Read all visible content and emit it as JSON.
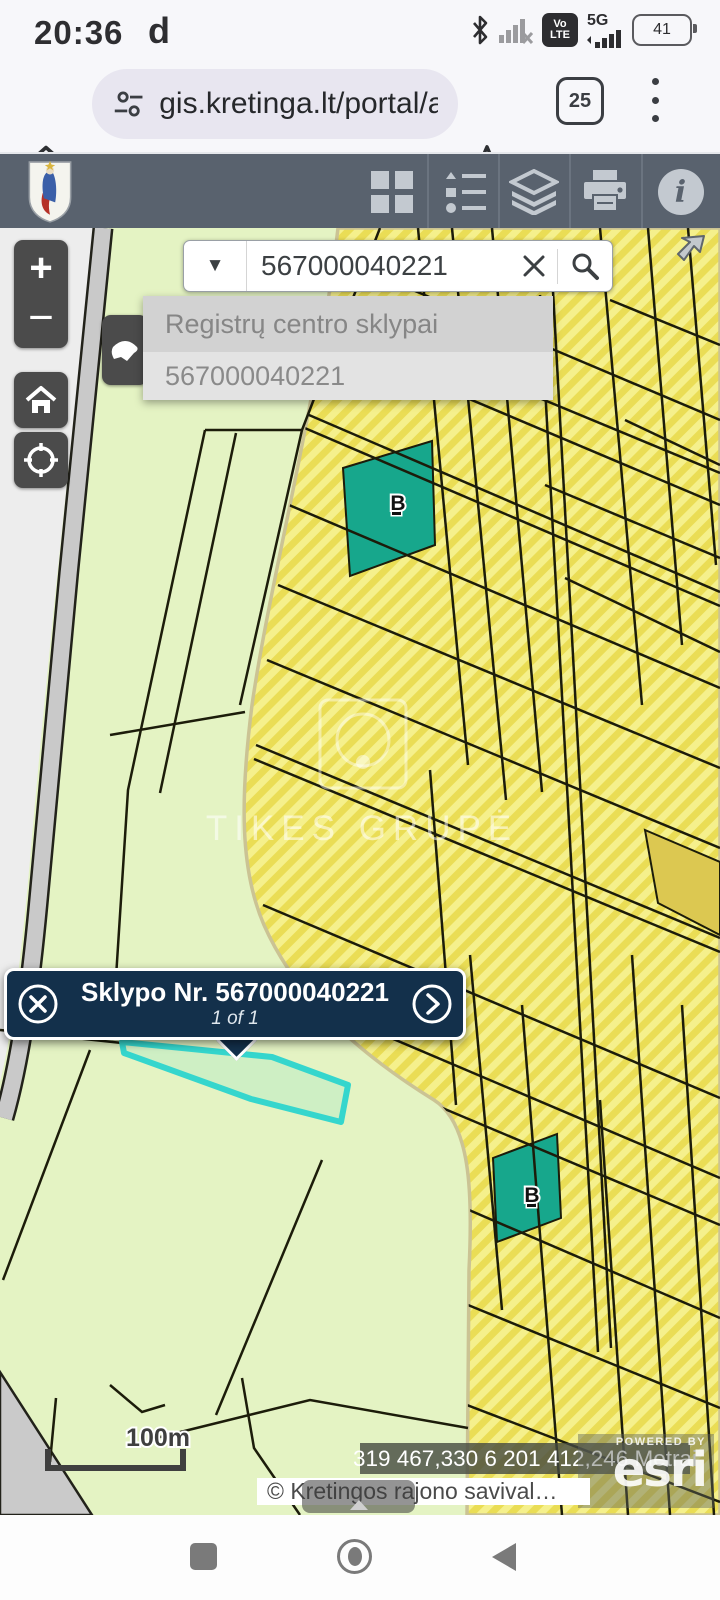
{
  "status_bar": {
    "time": "20:36",
    "carrier_badge": "d",
    "volte_top": "Vo",
    "volte_bottom": "LTE",
    "network_label": "5G",
    "battery_percent": "41"
  },
  "browser_bar": {
    "url": "gis.kretinga.lt/portal/a",
    "tab_count": "25"
  },
  "map_widgets": {
    "zoom_in_label": "+",
    "zoom_out_label": "−",
    "search": {
      "value": "567000040221",
      "suggestion_header": "Registrų centro sklypai",
      "suggestion_value": "567000040221"
    },
    "popup": {
      "title": "Sklypo Nr. 567000040221",
      "pager": "1 of 1"
    },
    "parcel_labels": {
      "b1": "B",
      "b2": "B"
    },
    "watermark_text": "TIKES GRUPĖ",
    "scale_label": "100m",
    "coordinates": "319 467,330 6 201 412,246 Metrai",
    "attribution": "© Kretingos rajono savival…",
    "powered_by": "POWERED BY",
    "esri_logo": "esri"
  },
  "colors": {
    "toolbar_bg": "#59626e",
    "parcel_green": "#e4f3c3",
    "parcel_yellow_light": "#f5f08c",
    "parcel_yellow_dark": "#eadd55",
    "teal_parcel": "#17a78c",
    "selection_cyan": "#35d6cd",
    "popup_bg": "#13304b",
    "road_gray": "#c9c9c9"
  }
}
